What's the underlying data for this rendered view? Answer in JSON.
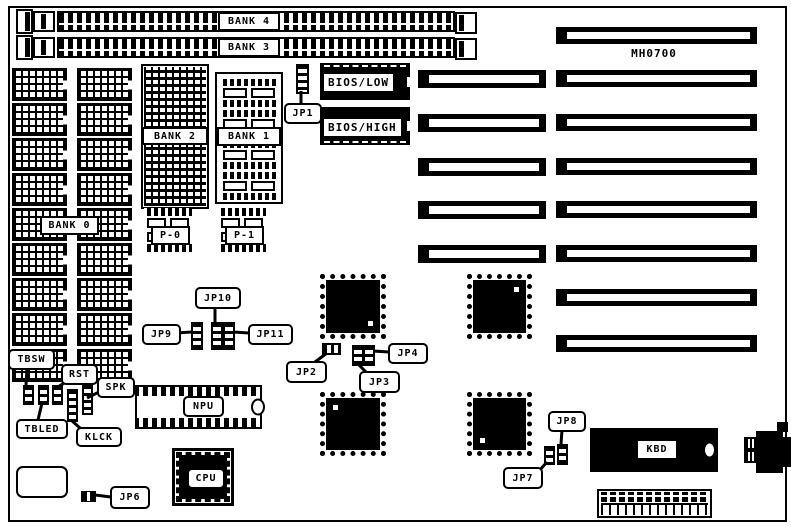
{
  "board_title": "MH0700",
  "simm": {
    "bank4": "BANK 4",
    "bank3": "BANK 3"
  },
  "memory": {
    "bank0": "BANK 0",
    "bank1": "BANK 1",
    "bank2": "BANK 2",
    "p0": "P-0",
    "p1": "P-1"
  },
  "bios": {
    "low": "BIOS/LOW",
    "high": "BIOS/HIGH"
  },
  "jumpers": {
    "jp1": "JP1",
    "jp2": "JP2",
    "jp3": "JP3",
    "jp4": "JP4",
    "jp6": "JP6",
    "jp7": "JP7",
    "jp8": "JP8",
    "jp9": "JP9",
    "jp10": "JP10",
    "jp11": "JP11"
  },
  "connectors": {
    "tbsw": "TBSW",
    "rst": "RST",
    "spk": "SPK",
    "tbled": "TBLED",
    "klck": "KLCK"
  },
  "chips": {
    "npu": "NPU",
    "cpu": "CPU",
    "kbd": "KBD"
  },
  "colors": {
    "ink": "#000000",
    "paper": "#ffffff"
  }
}
